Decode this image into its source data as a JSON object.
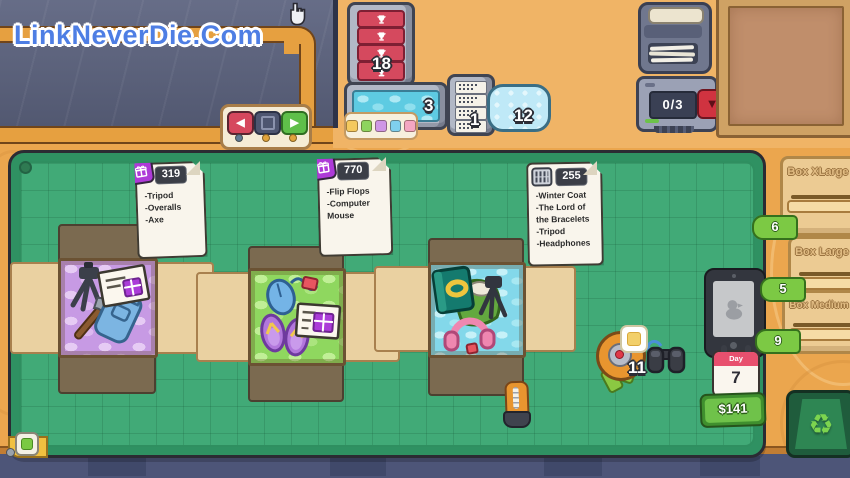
{
  "meta": {
    "watermark": "LinkNeverDie.Com"
  },
  "colors": {
    "mat_green": "#41aa77",
    "wood": "#eba64e",
    "tab_green": "#7cc944",
    "gift_purple": "#ae3ad8",
    "trophy_red": "#d5495e",
    "money_green": "#6fc24a",
    "calendar_red": "#e8506e"
  },
  "icons": {
    "nav_left": "◀",
    "nav_right": "▶",
    "confirm_arrow": "▼",
    "recycle": "♻"
  },
  "shelf": {
    "trophy_count": "18",
    "bubble_wrap_count": "3",
    "receipt_count": "1",
    "cushion_count": "12",
    "palette": [
      "#f4c95e",
      "#8ed45e",
      "#cf97e6",
      "#7fd0ee",
      "#f4a6c2"
    ]
  },
  "machines": {
    "counter": "0/3"
  },
  "orders": [
    {
      "number": "319",
      "type": "gift",
      "items": "-Tripod\n-Overalls\n-Axe"
    },
    {
      "number": "770",
      "type": "gift",
      "items": "-Flip Flops\n-Computer\nMouse"
    },
    {
      "number": "255",
      "type": "shred",
      "items": "-Winter Coat\n-The Lord of\nthe Bracelets\n-Tripod\n-Headphones"
    }
  ],
  "tools": {
    "tape_count": "11"
  },
  "box_slots": [
    {
      "label": "Box XLarge",
      "count": "6"
    },
    {
      "label": "Box Large",
      "count": "5"
    },
    {
      "label": "Box Medium",
      "count": "9"
    }
  ],
  "hud": {
    "day_label": "Day",
    "day_value": "7",
    "money": "$141"
  }
}
